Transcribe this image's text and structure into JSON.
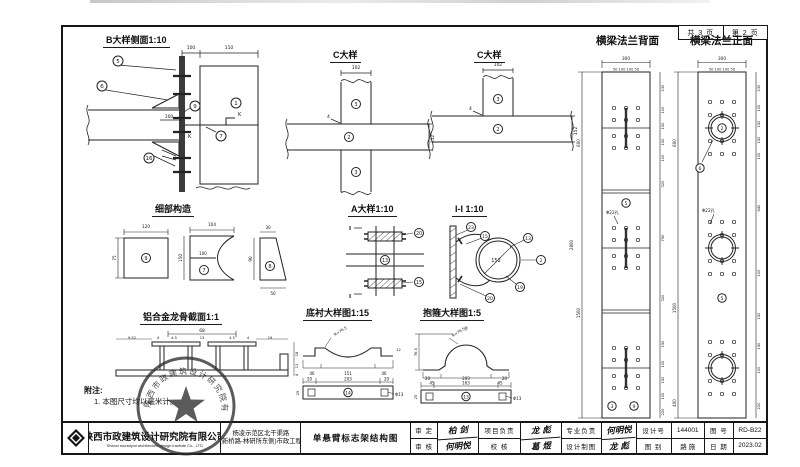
{
  "frame": {
    "page_total": "共 3 页",
    "page_current": "第 2 页"
  },
  "details": {
    "b": {
      "title": "B大样侧面1:10",
      "labels": {
        "p5": "5",
        "p6": "6",
        "p9": "9",
        "p7": "7",
        "p16": "16",
        "p1": "1"
      },
      "dims": {
        "d100a": "100",
        "d110": "110",
        "d100b": "100"
      },
      "k_mark": "K"
    },
    "c1": {
      "title": "C大样",
      "labels": {
        "top": "3",
        "mid": "2",
        "bot": "3"
      },
      "dims": {
        "w": "102",
        "h": "152"
      },
      "weld": "4"
    },
    "c2": {
      "title": "C大样",
      "labels": {
        "top": "3",
        "mid": "2"
      },
      "dims": {
        "w": "102",
        "h": "152"
      },
      "weld": "4"
    },
    "flange_back": {
      "title": "横梁法兰背面",
      "dim_total": "300",
      "dim_spacing": "50 100 100 50",
      "hole_note": "Φ22孔",
      "label5": "5",
      "label3": "3",
      "label9": "9",
      "left_dims": [
        "600",
        "1500",
        "2800"
      ],
      "right_dims": [
        "230",
        "100",
        "150",
        "150",
        "100",
        "320",
        "750",
        "320",
        "150",
        "100",
        "150",
        "100",
        "220"
      ]
    },
    "flange_front": {
      "title": "横梁法兰正面",
      "dim_total": "300",
      "dim_spacing": "50 100 100 50",
      "hole_note": "Φ22孔",
      "label2": "2",
      "label6": "6",
      "label5": "5",
      "left_dims": [
        "600",
        "1500",
        "400"
      ],
      "right_dims": [
        "230",
        "100",
        "150",
        "150",
        "100",
        "640",
        "100",
        "150",
        "150",
        "100",
        "220"
      ]
    },
    "parts": {
      "title": "细部构造",
      "square": {
        "label": "9",
        "w": "120",
        "h": "75"
      },
      "concave": {
        "label": "7",
        "w": "104",
        "mid": "100",
        "h": "150"
      },
      "wedge": {
        "label": "8",
        "top": "30",
        "bottom": "50",
        "h": "90"
      }
    },
    "a": {
      "title": "A大样1:10",
      "labels": {
        "top": "20",
        "mid": "13",
        "bot": "15"
      },
      "section_mark": "I"
    },
    "ii": {
      "title": "I-I 1:10",
      "dia": "152",
      "labels": {
        "l23": "23",
        "l15": "15",
        "l13": "13",
        "l2": "2",
        "l19": "19",
        "l20": "20"
      }
    },
    "keel": {
      "title": "铝合金龙骨截面1:1",
      "dim_top": "68",
      "sub_dims": [
        "9.52",
        "4",
        "4.5",
        "13",
        "4.5",
        "4",
        "19"
      ],
      "right_dims": [
        "18",
        "11",
        "4"
      ]
    },
    "liner": {
      "title": "底衬大样图1:15",
      "radius": "R=76.5",
      "side_dim": "12",
      "profile_dims": [
        "46",
        "151",
        "46"
      ],
      "bar_dims": [
        "20",
        "203",
        "20"
      ],
      "hole": "Φ13",
      "label": "14",
      "bar_h": "25"
    },
    "clamp": {
      "title": "抱箍大样图1:5",
      "radius": "R=76.5",
      "height": "76.5",
      "profile_dims": [
        "45",
        "163",
        "45"
      ],
      "bar_dims": [
        "20",
        "203",
        "20"
      ],
      "hole": "Φ13",
      "label": "13",
      "bar_h": "25"
    }
  },
  "notes": {
    "heading": "附注:",
    "line1": "1. 本图尺寸均以毫米计。"
  },
  "stamp": {
    "ring_text": "陕西市政建筑设计研究院有限公司"
  },
  "titleblock": {
    "company_cn": "陕西市政建筑设计研究院有限公司",
    "company_en": "Shanxi municipal architecture design institute Co., LTD",
    "project_line1": "杨凌示范区北干渠路",
    "project_line2": "(新桥路-林研所东侧)市政工程",
    "drawing_title": "单悬臂标志架结构图",
    "fields": {
      "shending_label": "审 定",
      "shending_value": "柏 剑",
      "shenhe_label": "审 核",
      "shenhe_value": "何明悦",
      "xiangmu_label": "项目负责",
      "xiangmu_value": "龙 彪",
      "jiaohe_label": "校 核",
      "jiaohe_value": "葛 煜",
      "zhuanye_label": "专业负责",
      "zhuanye_value": "何明悦",
      "zhitu_label": "设计制图",
      "zhitu_value": "龙 彪",
      "shejihao_label": "设计号",
      "shejihao_value": "144001",
      "tubie_label": "图 别",
      "tubie_value": "路 施",
      "tuhao_label": "图 号",
      "tuhao_value": "RD-B22",
      "riqi_label": "日 期",
      "riqi_value": "2023.02"
    }
  }
}
